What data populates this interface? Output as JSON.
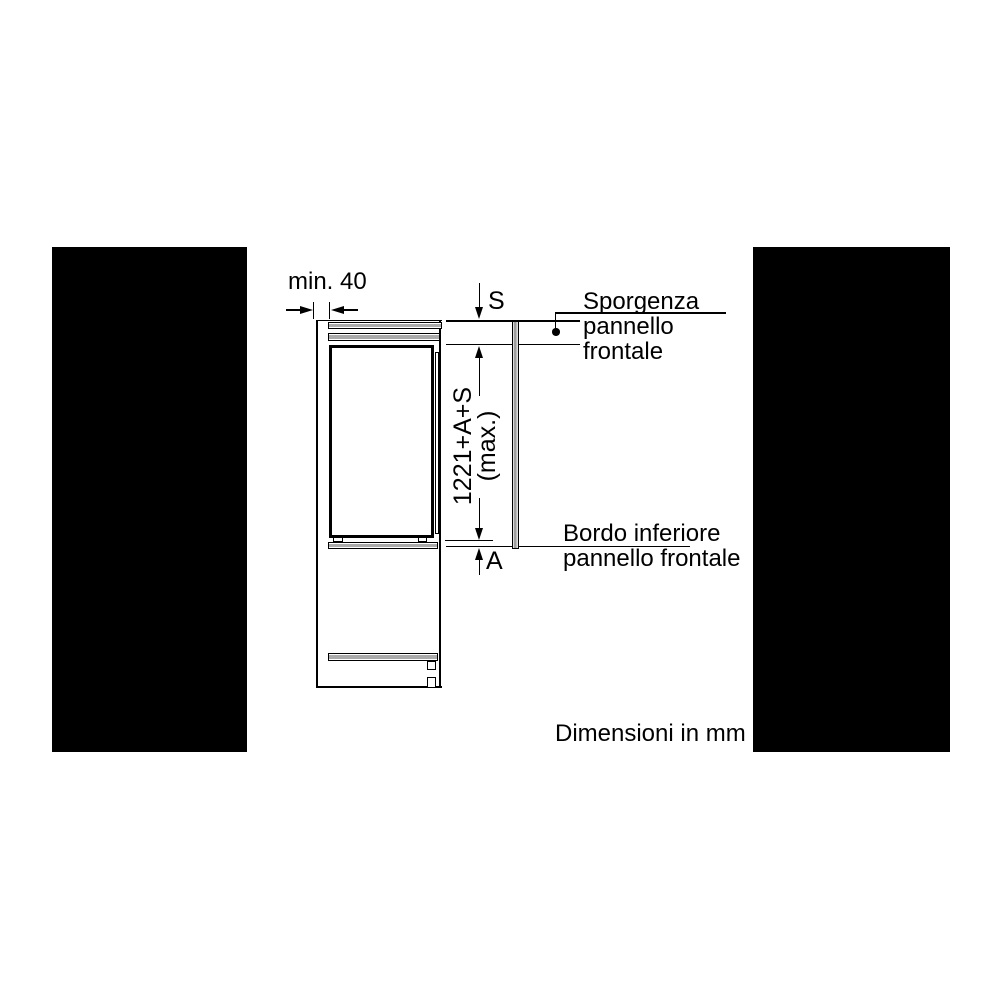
{
  "diagram": {
    "dimensions": {
      "min_gap": "min. 40",
      "top_protrusion": "S",
      "bottom_protrusion": "A",
      "panel_height": "1221+A+S",
      "panel_height_qualifier": "(max.)"
    },
    "annotations": {
      "sporgenza": [
        "Sporgenza",
        "pannello",
        "frontale"
      ],
      "bordo": [
        "Bordo inferiore",
        "pannello frontale"
      ],
      "units_note": "Dimensioni in mm"
    },
    "colors": {
      "line": "#000000",
      "gray_fill": "#ababab",
      "mask": "#000000",
      "background": "#ffffff"
    }
  }
}
